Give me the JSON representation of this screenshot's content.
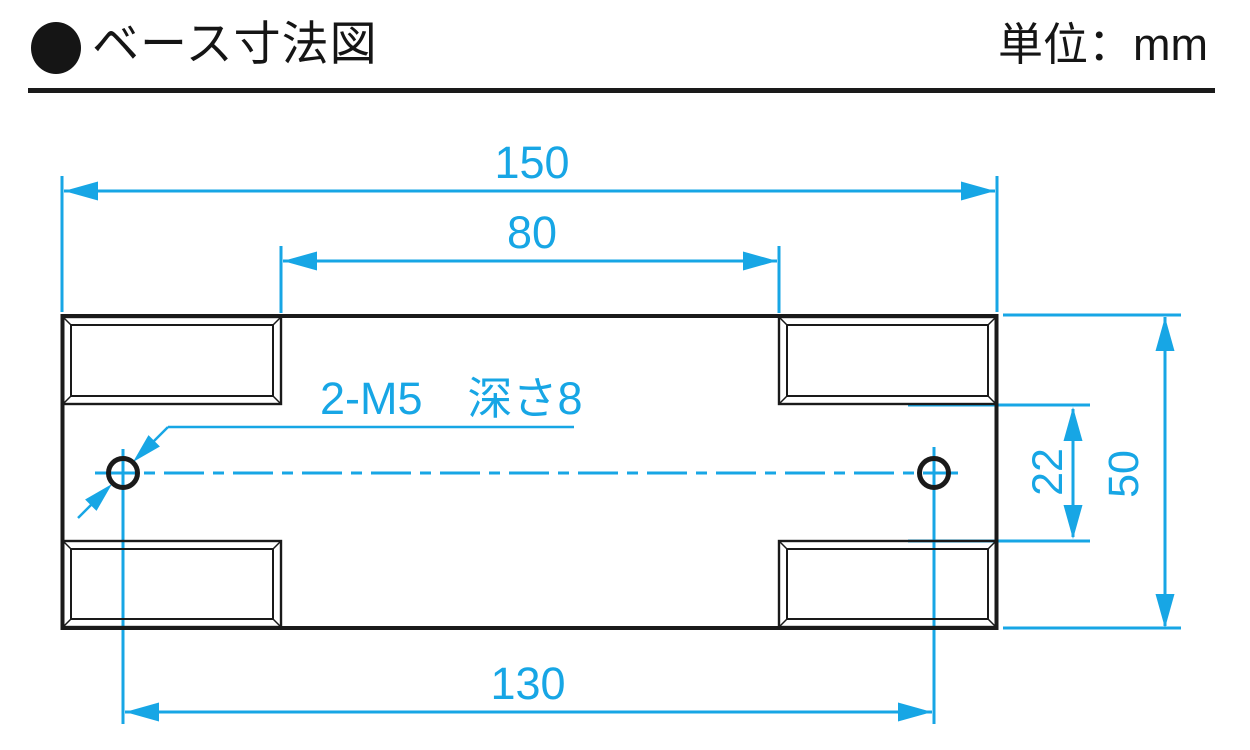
{
  "header": {
    "title": "ベース寸法図",
    "unit_label": "単位：mm"
  },
  "icons": {
    "section_bullet": "filled-circle"
  },
  "drawing": {
    "unit": "mm",
    "dimensions": {
      "overall_width": "150",
      "top_slot_span": "80",
      "hole_pitch": "130",
      "overall_height": "50",
      "slot_edge_gap": "22"
    },
    "annotations": {
      "tapped_holes": "2-M5　深さ8"
    },
    "colors": {
      "dimension_lines": "#17a6e5",
      "object_lines": "#1a1a1a"
    }
  }
}
